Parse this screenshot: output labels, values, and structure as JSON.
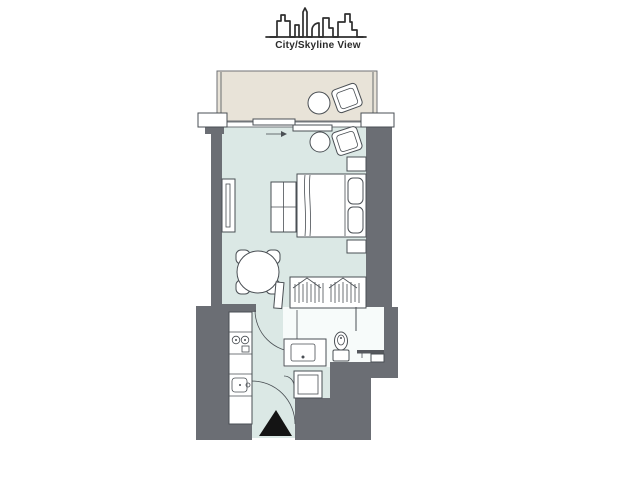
{
  "header": {
    "title": "City/Skyline View",
    "icon": "city-skyline-icon"
  },
  "colors": {
    "wall": "#6b6e74",
    "room": "#dbe8e5",
    "balcony": "#e8e3d8",
    "balcony_border": "#8a8d90",
    "outline": "#4a4f54",
    "marker": "#141414",
    "background": "#ffffff",
    "bath": "#f7fbfa"
  },
  "plan": {
    "type": "studio-apartment-floor-plan",
    "view_label": "City/Skyline View",
    "areas": [
      "balcony",
      "living-sleeping-area",
      "kitchen",
      "hallway",
      "bathroom",
      "wardrobe",
      "laundry-closet"
    ],
    "furniture": [
      "lounge-chair",
      "side-table",
      "double-bed",
      "pillows",
      "nightstand",
      "tv-unit",
      "mirror",
      "round-dining-table",
      "dining-chairs",
      "kitchen-counter",
      "cooktop",
      "kitchen-sink",
      "wardrobe-hangers",
      "vanity-sink",
      "toilet",
      "shower-head",
      "washing-machine",
      "sliding-door",
      "entrance-door",
      "entrance-marker"
    ]
  }
}
